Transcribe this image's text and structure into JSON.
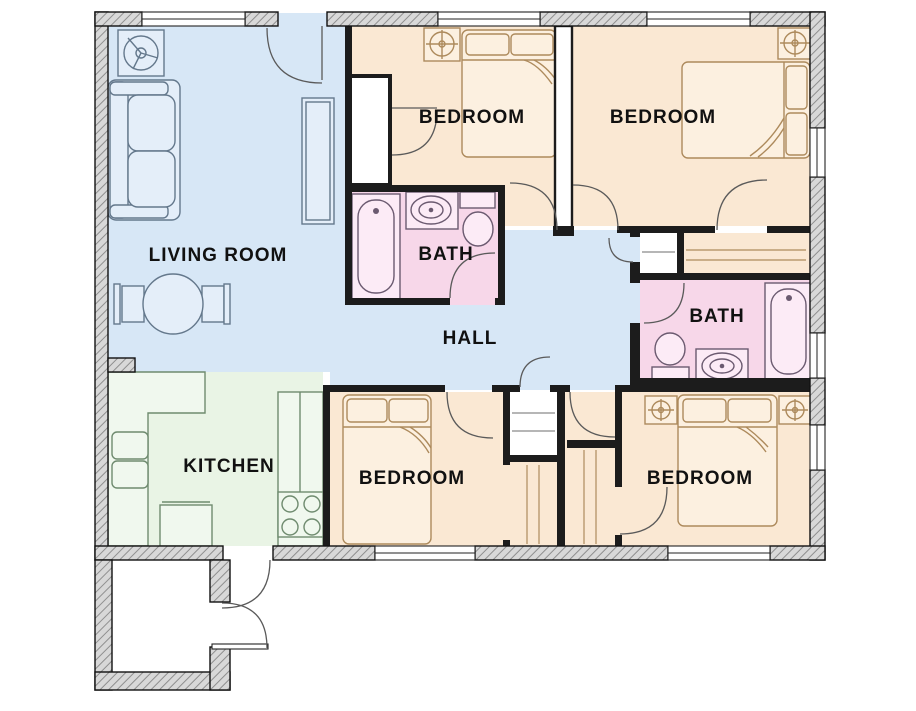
{
  "plan_title": "3-bed-2-bath house floor plan",
  "colors": {
    "living": "#d7e7f6",
    "hall": "#d7e7f6",
    "bedroom": "#fae8d3",
    "bath": "#f7d7e9",
    "kitchen": "#e9f4e5",
    "closet": "#ffffff",
    "wall": "#1c1c1c",
    "wall_hatch_bg": "#d8d8d8",
    "wall_hatch_line": "#8f8f8f",
    "door_arc": "#5a5a5a",
    "furniture_living": "#64788c",
    "furniture_bed": "#ad8a5c",
    "furniture_bath": "#6b5a70",
    "furniture_kitchen": "#6f8b6f",
    "label_text": "#111111"
  },
  "rooms": {
    "living": {
      "label": "LIVING ROOM"
    },
    "bedroom1": {
      "label": "BEDROOM"
    },
    "bedroom2": {
      "label": "BEDROOM"
    },
    "bedroom3": {
      "label": "BEDROOM"
    },
    "bedroom4": {
      "label": "BEDROOM"
    },
    "bath1": {
      "label": "BATH"
    },
    "bath2": {
      "label": "BATH"
    },
    "hall": {
      "label": "HALL"
    },
    "kitchen": {
      "label": "KITCHEN"
    }
  },
  "fixtures": {
    "living_room": [
      "ceiling-fan-icon",
      "sofa",
      "tall-cabinet",
      "round-table-with-chairs"
    ],
    "bedrooms": [
      "ceiling-fan-icon",
      "double-bed",
      "nightstand-lamp-icon",
      "closet-shelves"
    ],
    "baths": [
      "bathtub",
      "sink-basin",
      "toilet"
    ],
    "kitchen": [
      "l-shaped-counter",
      "double-sink",
      "island-counter",
      "stove-4-burners"
    ],
    "entry": [
      "porch",
      "entry-door-swings",
      "threshold-step"
    ]
  }
}
